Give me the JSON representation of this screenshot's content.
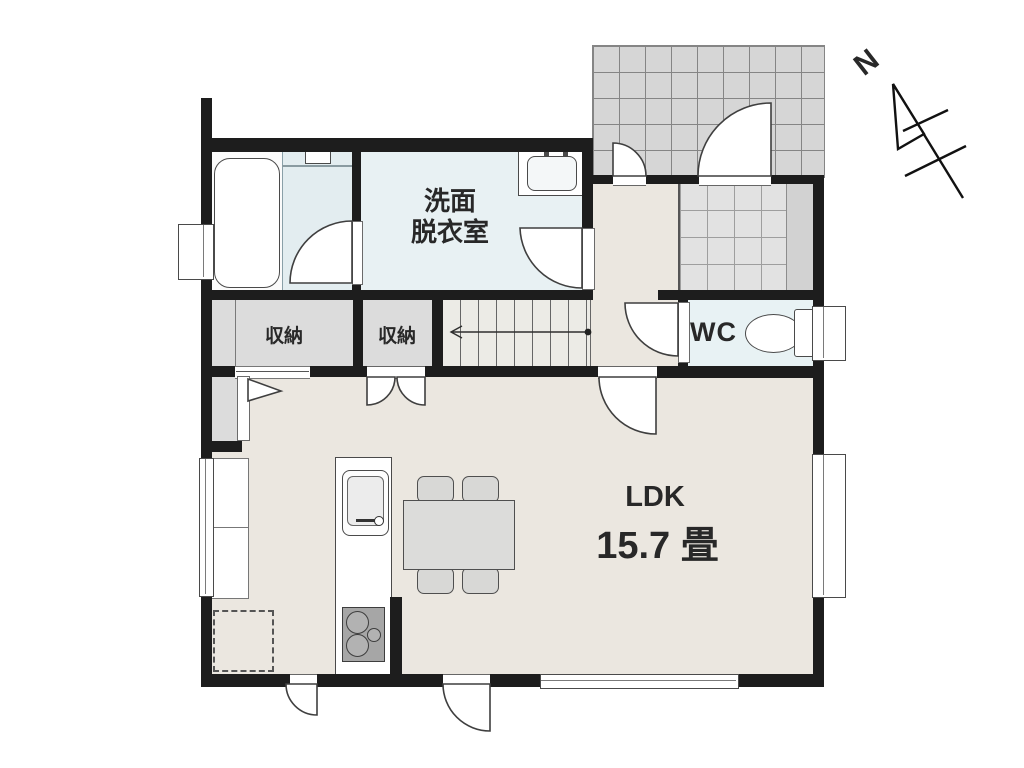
{
  "labels": {
    "washroom_line1": "洗面",
    "washroom_line2": "脱衣室",
    "storage_left": "収納",
    "storage_right": "収納",
    "wc": "WC",
    "ldk": "LDK",
    "ldk_area": "15.7 畳",
    "compass_north": "N"
  },
  "colors": {
    "wall": "#1d1d1d",
    "floor": "#ebe7e0",
    "bath_wet_area": "#e3edf0",
    "washroom": "#e8f1f3",
    "wc": "#e8f2f4",
    "storage": "#dcdcdc",
    "porch_tile": "#d6d6d6",
    "genkan_tile": "#e2e2e2",
    "outline": "#3f3f3f"
  }
}
